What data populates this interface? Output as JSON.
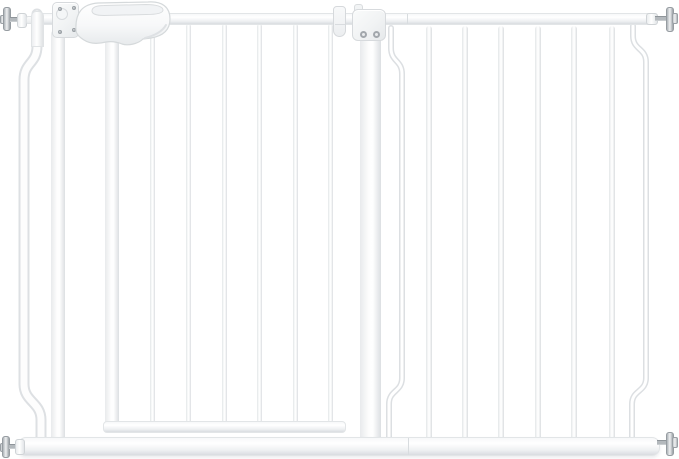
{
  "meta": {
    "description": "Product photo of a white extra-wide pressure-mounted metal baby safety gate: walk-through door with plastic latch handle at top left, latch post plate with screws, junction bracket joining an extension panel of vertical bars, and four threaded spindle mounting bolts at the corners",
    "background_color": "#ffffff"
  },
  "palette": {
    "gate_white": "#ffffff",
    "bar_edge_gray": "#dcdfe2",
    "rail_shade_gray": "#e9ebee",
    "outline_gray": "#d5d9db",
    "hardware_metal_light": "#eef0f1",
    "hardware_metal": "#b3b8bd",
    "hardware_metal_dark": "#8f959a"
  },
  "gate": {
    "door": {
      "bar_count": 6,
      "bars_x": [
        150,
        186,
        222,
        257,
        293,
        328
      ]
    },
    "extension": {
      "straight_bar_count": 6,
      "bars_x": [
        426,
        462,
        498,
        535,
        571,
        609
      ],
      "curved_bar_count": 2
    },
    "hardware": {
      "spindle_bolt_count": 4,
      "latch_plate_screw_count": 4,
      "bracket_screw_count": 2
    }
  }
}
